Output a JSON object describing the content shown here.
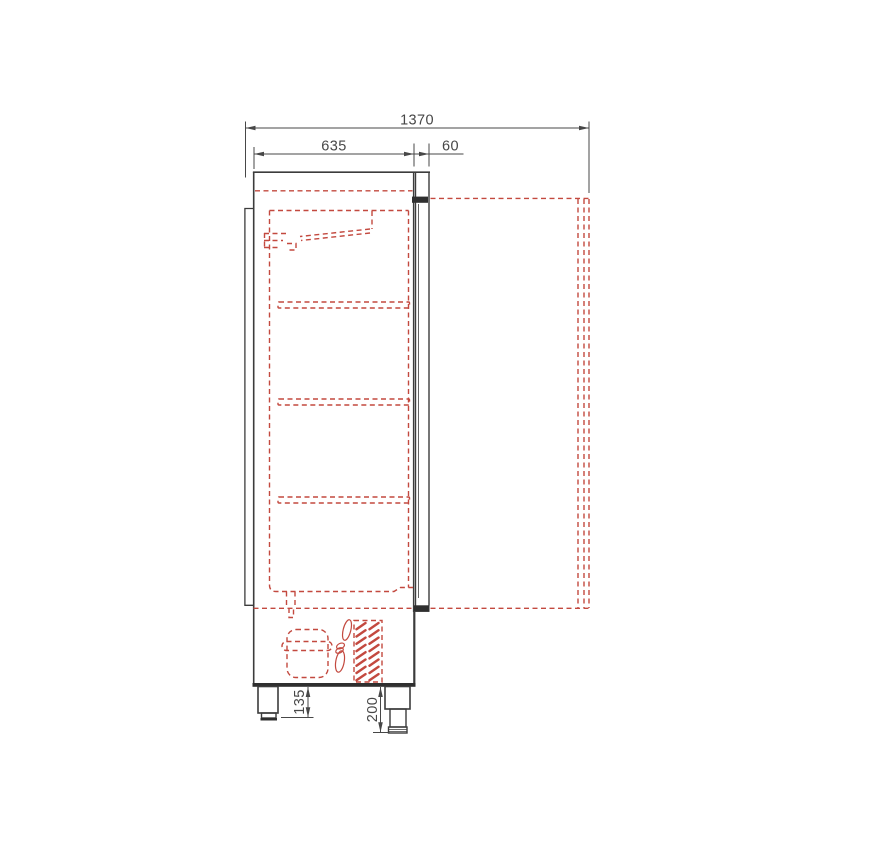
{
  "drawing": {
    "kind": "refrigerated-cabinet-side-view"
  },
  "dimensions": {
    "total_depth_mm": "1370",
    "body_depth_mm": "635",
    "door_thickness_mm": "60",
    "rear_leg_height_mm": "135",
    "front_leg_height_mm": "200"
  },
  "colors": {
    "line": "#3c3c3c",
    "dimension": "#474747",
    "red_dashed": "#c3493f",
    "background": "#ffffff"
  }
}
